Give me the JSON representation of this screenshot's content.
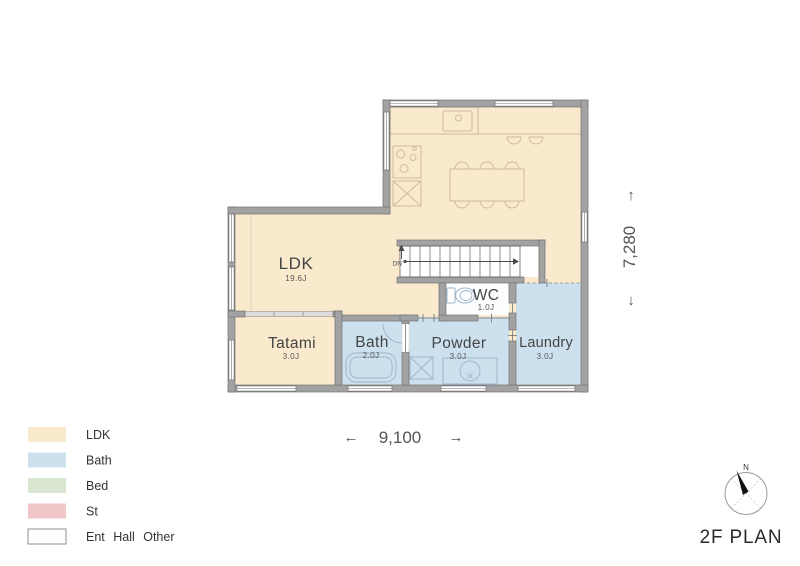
{
  "title": "2F PLAN",
  "compass": {
    "north_label": "N"
  },
  "stairs": {
    "label": "DN"
  },
  "dimensions": {
    "width_value": "9,100",
    "width_arrow_left": "←",
    "width_arrow_right": "→",
    "height_value": "7,280",
    "height_arrow_up": "↑",
    "height_arrow_down": "↓"
  },
  "rooms": {
    "ldk": {
      "label": "LDK",
      "size": "19.6J"
    },
    "tatami": {
      "label": "Tatami",
      "size": "3.0J"
    },
    "bath": {
      "label": "Bath",
      "size": "2.0J"
    },
    "wc": {
      "label": "WC",
      "size": "1.0J"
    },
    "powder": {
      "label": "Powder",
      "size": "3.0J"
    },
    "laundry": {
      "label": "Laundry",
      "size": "3.0J"
    }
  },
  "legend": {
    "items": [
      {
        "label": "LDK",
        "color": "#f9e9cd"
      },
      {
        "label": "Bath",
        "color": "#cce0ee"
      },
      {
        "label": "Bed",
        "color": "#d9e7d2"
      },
      {
        "label": "St",
        "color": "#f1c6c8"
      },
      {
        "label": "Ent Hall Other",
        "color": "#ffffff"
      }
    ]
  },
  "colors": {
    "floor_ldk": "#f9e9cd",
    "floor_wet": "#cce0ee",
    "floor_other": "#fcfdfe",
    "wall": "#a2a2a2"
  }
}
